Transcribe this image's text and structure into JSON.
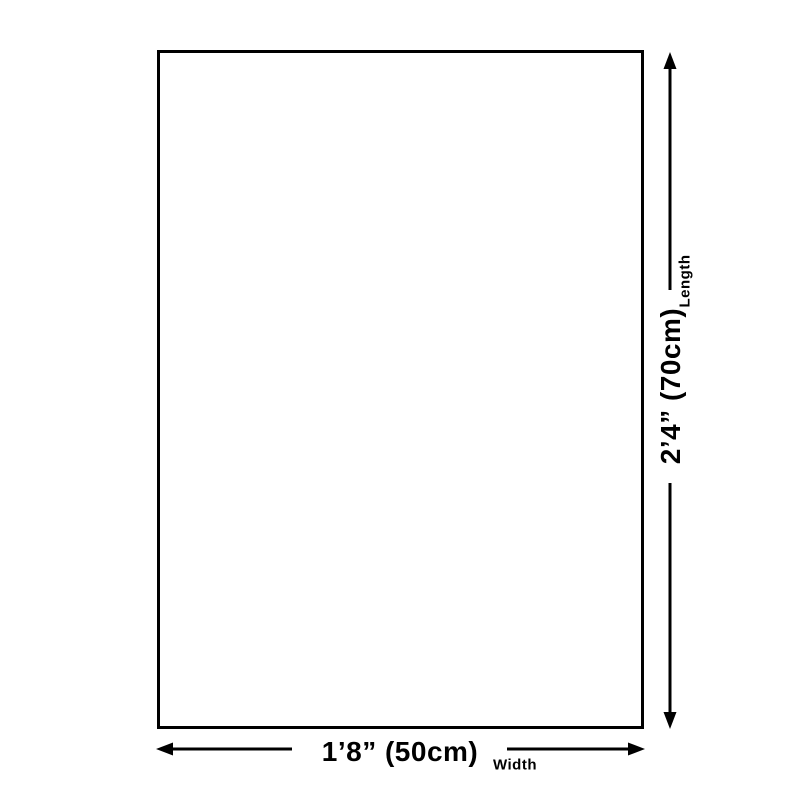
{
  "diagram": {
    "background_color": "#ffffff",
    "line_color": "#000000",
    "product_box": {
      "shape": "rectangle",
      "fill": "#ffffff",
      "border_color": "#000000"
    },
    "width_dimension": {
      "value": "1’8” (50cm)",
      "label": "Width"
    },
    "length_dimension": {
      "value": "2’4” (70cm)",
      "label": "Length"
    }
  }
}
